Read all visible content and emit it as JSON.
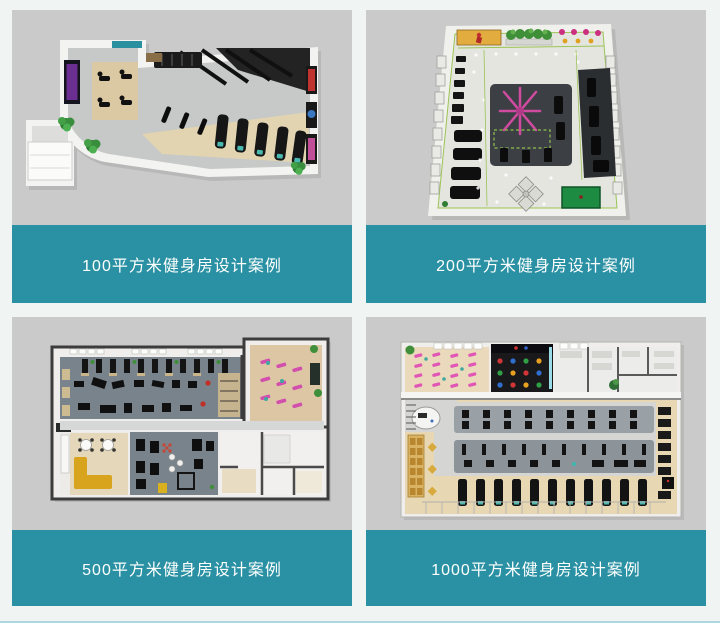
{
  "colors": {
    "page-bg": "#f0f4f2",
    "caption-bg": "#2991a3",
    "caption-text": "#ffffff",
    "thumb-bg": "#cacaca",
    "bottom-accent": "#abd7e2"
  },
  "cards": [
    {
      "caption": "100平方米健身房设计案例",
      "image": "floor-plan-100-sqm-gym-render"
    },
    {
      "caption": "200平方米健身房设计案例",
      "image": "floor-plan-200-sqm-gym-render"
    },
    {
      "caption": "500平方米健身房设计案例",
      "image": "floor-plan-500-sqm-gym-render"
    },
    {
      "caption": "1000平方米健身房设计案例",
      "image": "floor-plan-1000-sqm-gym-render"
    }
  ]
}
